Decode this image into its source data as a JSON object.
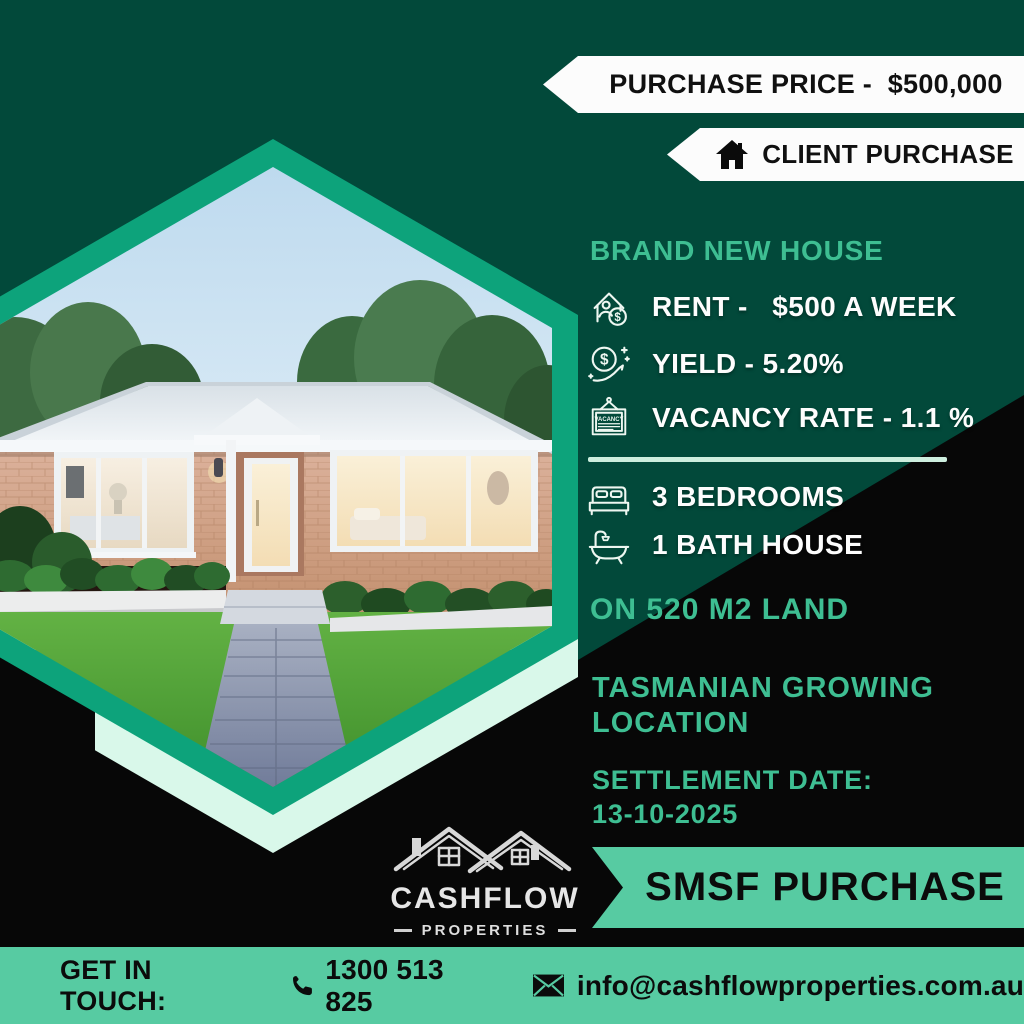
{
  "colors": {
    "dark_green_bg": "#02493A",
    "black_bg": "#070707",
    "hexagon_teal": "#0DA37B",
    "pale_mint": "#D9F8EA",
    "mint_accent": "#57CBA2",
    "teal_text": "#3EBE92",
    "banner_white": "#FCFCFC"
  },
  "top_banners": {
    "purchase_price_label": "PURCHASE PRICE -  $500,000",
    "client_purchase_label": "CLIENT PURCHASE"
  },
  "details": {
    "headline": "BRAND NEW HOUSE",
    "stats": [
      {
        "icon": "rent-house-dollar-icon",
        "label": "RENT -   $500 A WEEK"
      },
      {
        "icon": "yield-coin-growth-icon",
        "label": "YIELD - 5.20%"
      },
      {
        "icon": "vacancy-sign-icon",
        "label": "VACANCY RATE - 1.1 %"
      }
    ],
    "features": [
      {
        "icon": "bed-icon",
        "label": "3 BEDROOMS"
      },
      {
        "icon": "bathtub-icon",
        "label": "1 BATH HOUSE"
      }
    ],
    "land": "ON 520 M2 LAND",
    "location": "TASMANIAN GROWING LOCATION",
    "settlement_label": "SETTLEMENT DATE:",
    "settlement_date": "13-10-2025"
  },
  "vacancy_sign_text": "VACANCY",
  "smsf_banner": {
    "label": "SMSF PURCHASE"
  },
  "logo": {
    "name": "CASHFLOW",
    "subtitle": "PROPERTIES",
    "tagline": "YOUR RETIREMENT PATHWAY"
  },
  "footer": {
    "get_in_touch_label": "GET IN TOUCH:",
    "phone": "1300 513 825",
    "email": "info@cashflowproperties.com.au"
  }
}
